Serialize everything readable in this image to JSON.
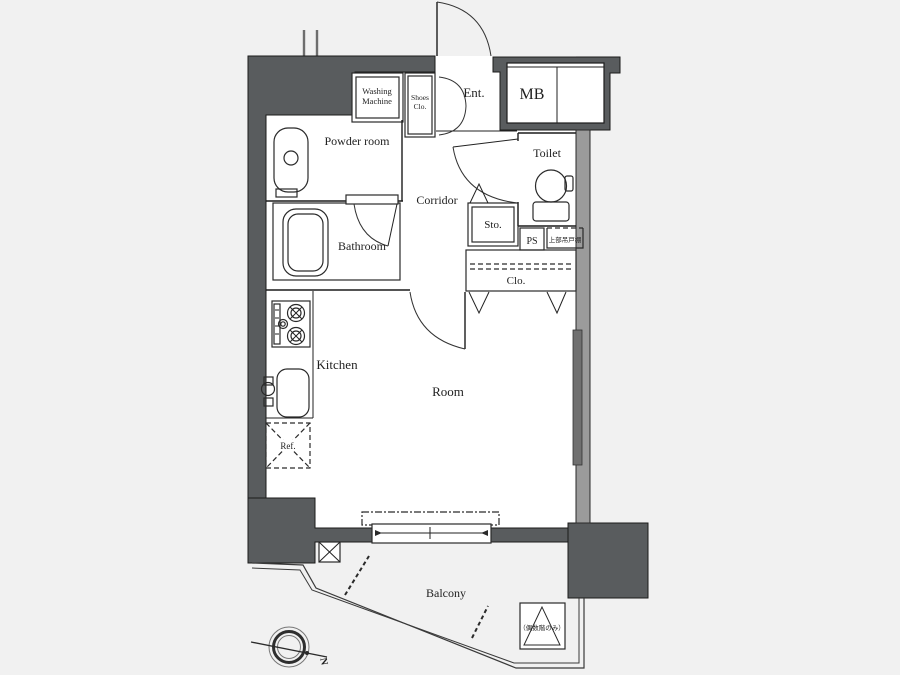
{
  "labels": {
    "washing_machine": [
      "Washing",
      "Machine"
    ],
    "shoes_closet": [
      "Shoes",
      "Clo."
    ],
    "entrance": "Ent.",
    "meter_box": "MB",
    "powder_room": "Powder room",
    "toilet": "Toilet",
    "corridor": "Corridor",
    "storage": "Sto.",
    "pipe_space": "PS",
    "upper_cabinet": "上部吊戸棚",
    "bathroom": "Bathroom",
    "closet": "Clo.",
    "kitchen": "Kitchen",
    "room": "Room",
    "refrigerator": "Ref.",
    "balcony": "Balcony",
    "hatch_note": "（偶数階のみ）",
    "compass_north": "N"
  },
  "colors": {
    "background": "#f1f1f1",
    "floor": "#ffffff",
    "wall_dark": "#595c5e",
    "wall_mid": "#9b9b9b",
    "window_gray": "#707070",
    "line": "#1c1c1c",
    "text": "#1f1f1f"
  }
}
